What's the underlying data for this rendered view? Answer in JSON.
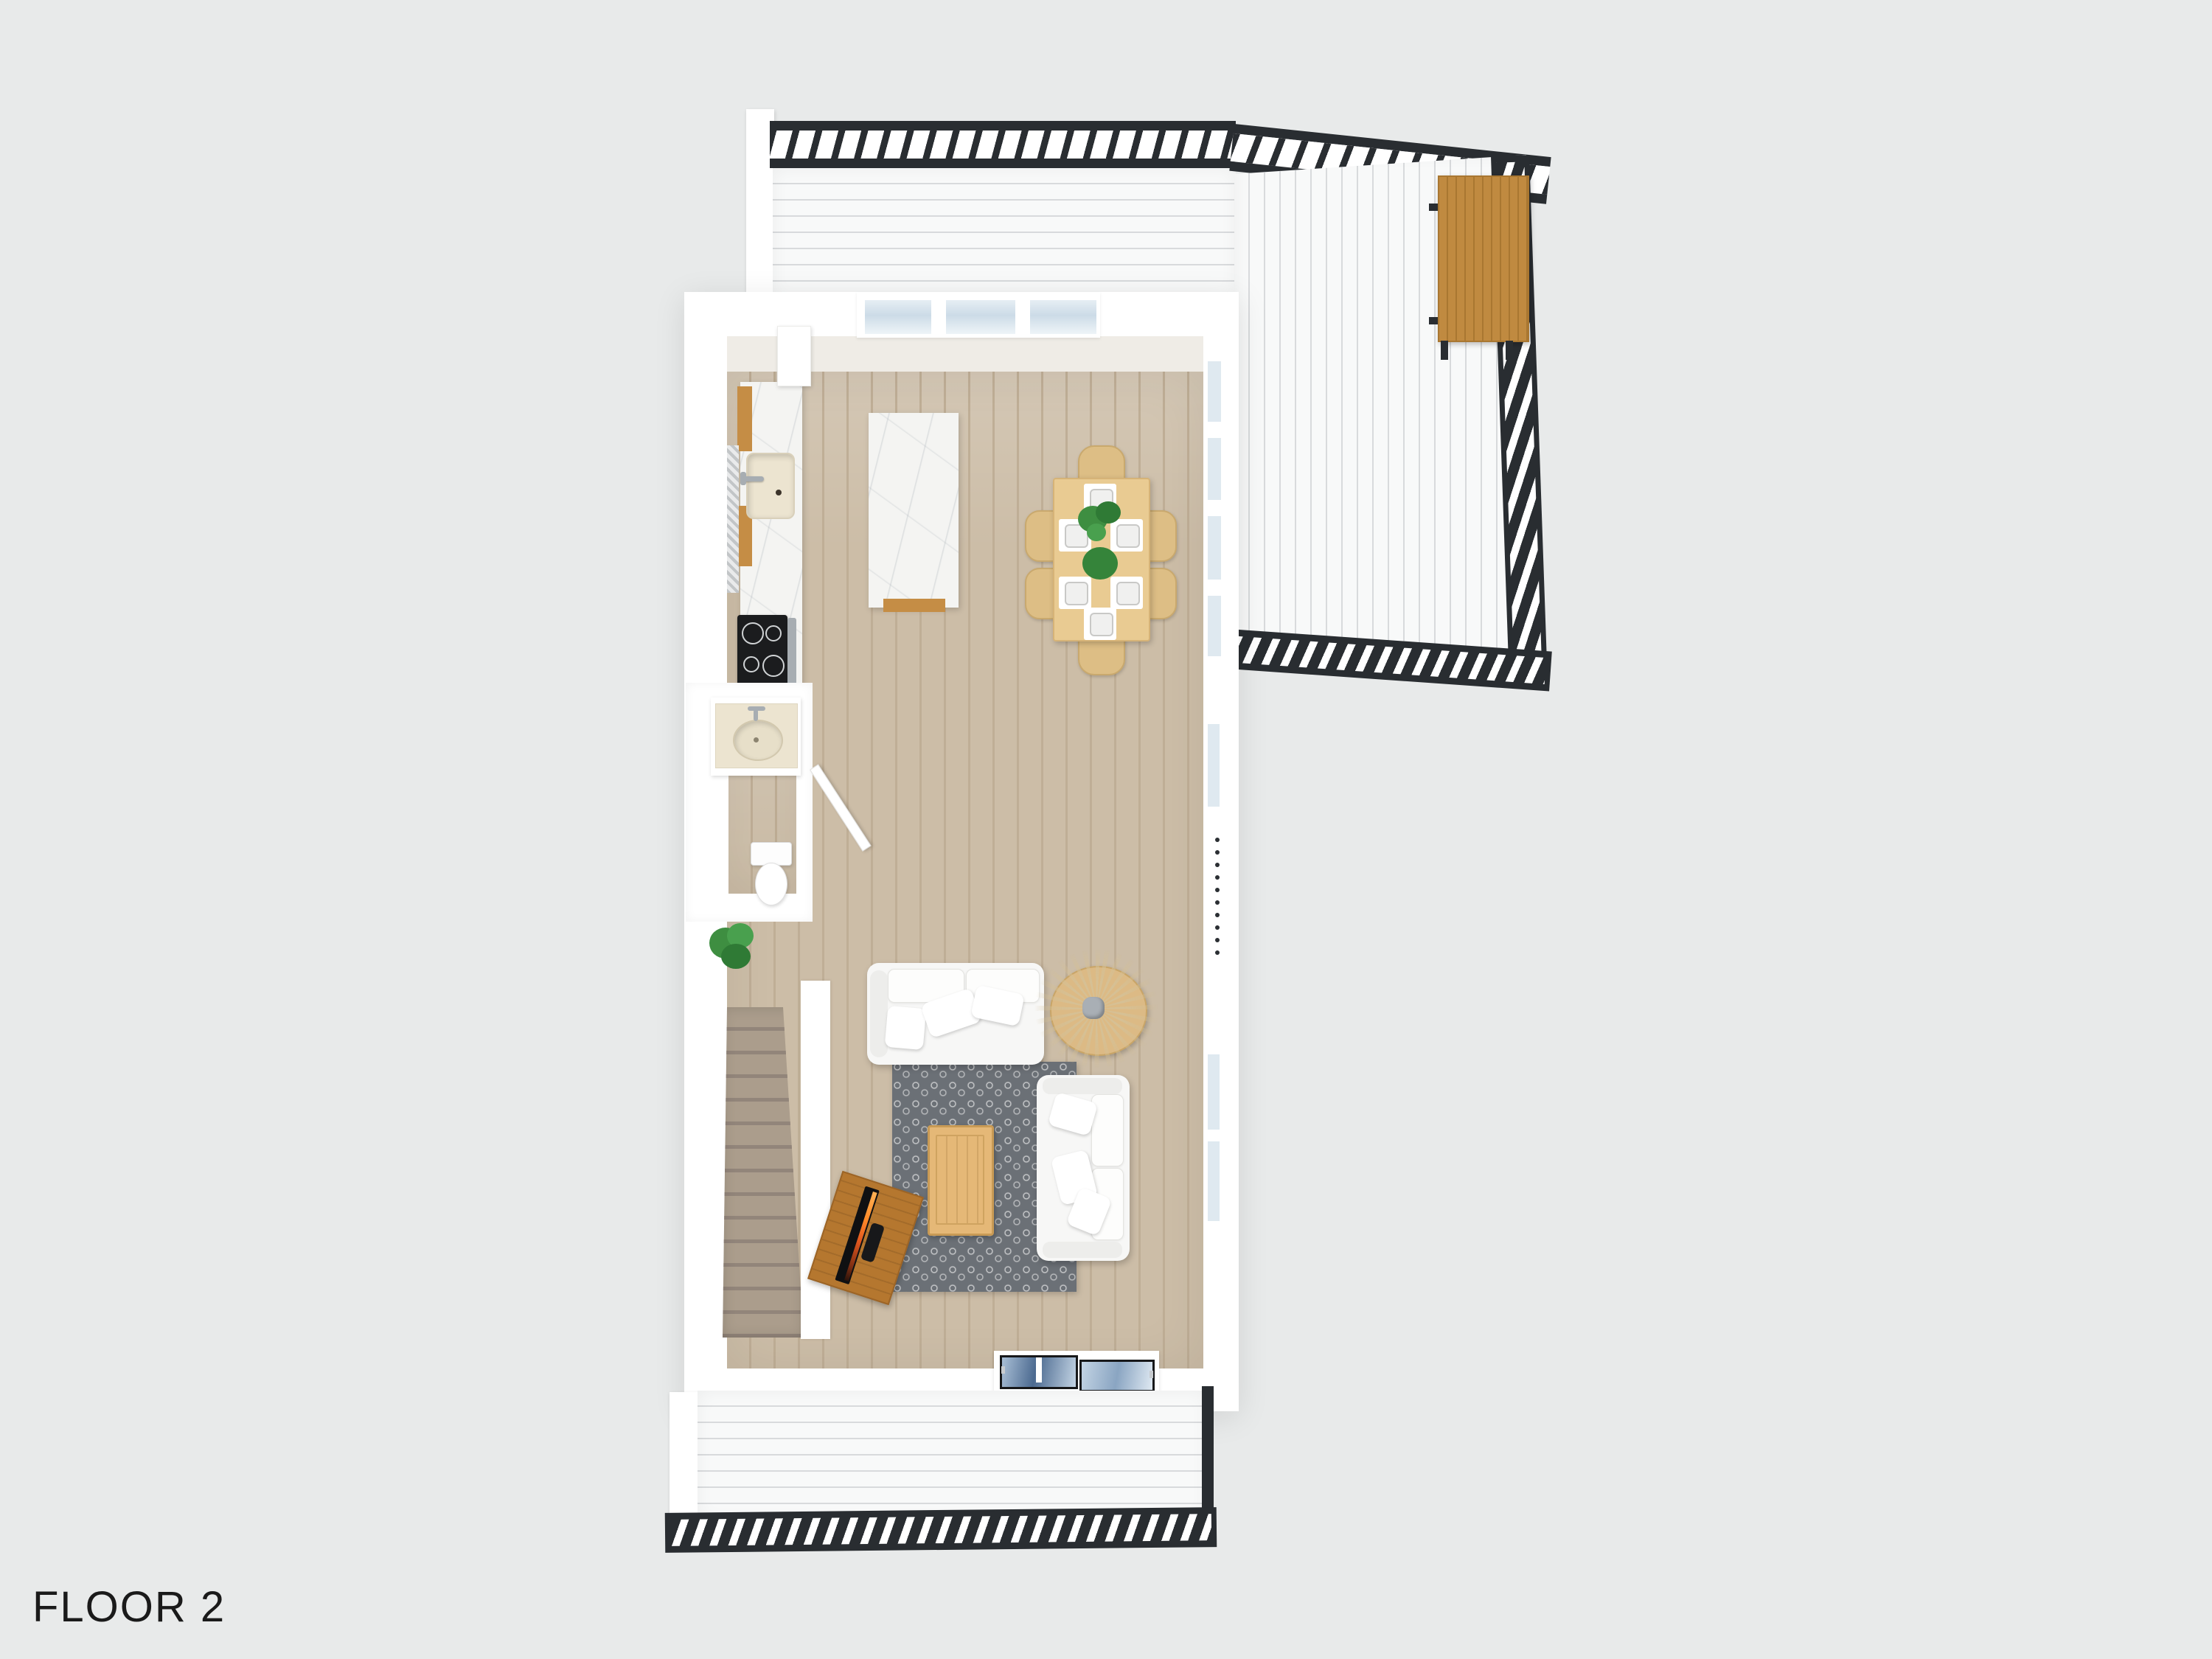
{
  "floor_label": "FLOOR 2",
  "palette": {
    "background": "#e8eaea",
    "wall": "#ffffff",
    "railing": "#292d31",
    "deck_board": "#f8f9f9",
    "wood_floor": "#ccbda7",
    "marble": "#f4f4f2",
    "cabinet_wood": "#c58d45",
    "bench_wood": "#c08a40",
    "dining_wood": "#e9cb92",
    "rug": "#6b7076",
    "coffee_table_wood": "#e5b877",
    "tv_stand_wood": "#b5772f",
    "stair_carpet": "#ab9d8c",
    "sofa": "#f7f7f6",
    "plant_green": "#3e8e41",
    "pampas": "#d5c095",
    "sink_cream": "#ece4d0",
    "stove_black": "#1b1c1e",
    "window_glass": "#dfe9f0",
    "skylight_glass": "#4c6a90",
    "text": "#1a1a1a"
  },
  "scene": {
    "type": "3d-floor-plan-top-view",
    "decks": [
      "top-deck",
      "side-deck-right",
      "bottom-deck"
    ],
    "rooms": [
      "kitchen",
      "dining-area",
      "powder-room",
      "stair-hall",
      "living-room"
    ],
    "objects": [
      "deck-railing-top",
      "deck-railing-right",
      "deck-railing-bottom",
      "outdoor-bench",
      "kitchen-counter",
      "kitchen-sink",
      "cooktop",
      "refrigerator",
      "kitchen-island",
      "dining-table",
      "dining-chairs",
      "place-settings",
      "table-plant",
      "bathroom-vanity",
      "bathroom-sink",
      "toilet",
      "bathroom-door",
      "potted-plant",
      "staircase",
      "area-rug",
      "sofa-large",
      "sofa-small",
      "coffee-table",
      "round-side-table",
      "pampas-plant",
      "tv-stand",
      "television",
      "skylights",
      "windows"
    ],
    "counts": {
      "dining_chairs": 6,
      "place_settings": 6,
      "sofas": 2,
      "skylights": 2,
      "stair_treads": 14
    }
  }
}
